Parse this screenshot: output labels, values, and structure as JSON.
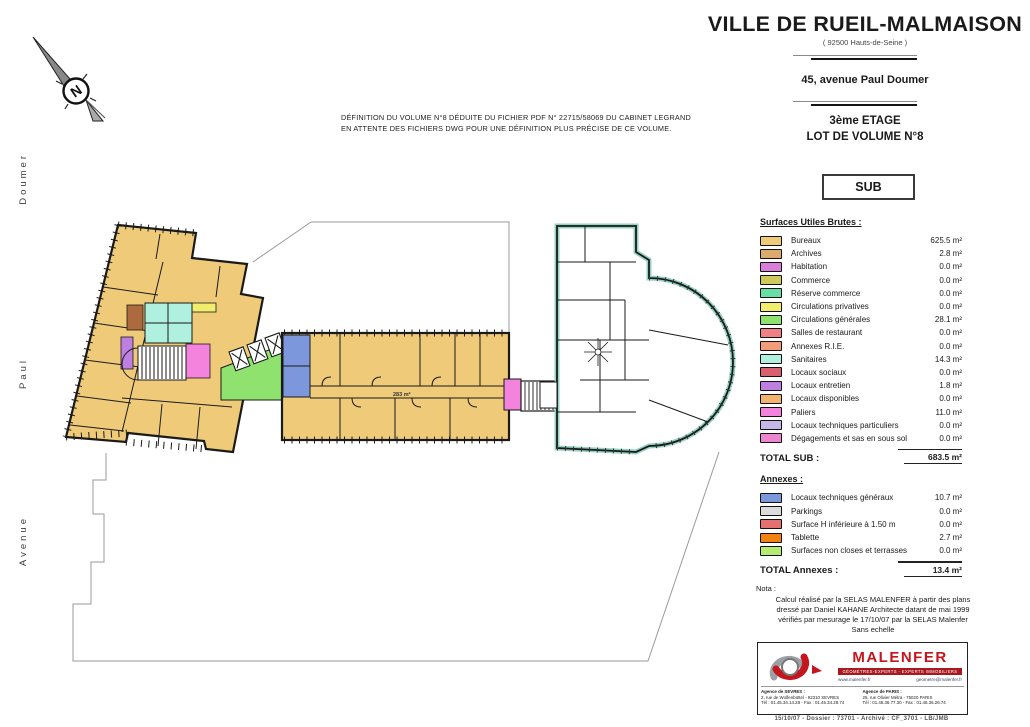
{
  "header": {
    "city": "VILLE DE RUEIL-MALMAISON",
    "dept": "( 92500 Hauts-de-Seine )",
    "address": "45, avenue Paul Doumer",
    "floor": "3ème ETAGE",
    "lot": "LOT DE VOLUME N°8",
    "type_label": "SUB"
  },
  "plan_note": {
    "line1": "DÉFINITION DU VOLUME N°8 DÉDUITE DU FICHIER PDF N° 22715/58069 DU CABINET LEGRAND",
    "line2": "EN ATTENTE DES FICHIERS DWG POUR UNE DÉFINITION PLUS PRÉCISE DE CE VOLUME."
  },
  "streets": {
    "top": "Doumer",
    "middle": "Paul",
    "bottom": "Avenue"
  },
  "compass": {
    "label": "N"
  },
  "plan": {
    "corridor_label": "283 m²",
    "colors": {
      "archives_room": "#ad6a3e",
      "teal_outline": "#93d2c3",
      "boundary": "#9a9a9a",
      "wall": "#1a1a1a"
    }
  },
  "legend": {
    "title": "Surfaces Utiles Brutes :",
    "items": [
      {
        "label": "Bureaux",
        "value": "625.5 m²",
        "color": "#EFCB79"
      },
      {
        "label": "Archives",
        "value": "2.8 m²",
        "color": "#DCA96E"
      },
      {
        "label": "Habitation",
        "value": "0.0 m²",
        "color": "#DA7FD9"
      },
      {
        "label": "Commerce",
        "value": "0.0 m²",
        "color": "#CDC95B"
      },
      {
        "label": "Réserve commerce",
        "value": "0.0 m²",
        "color": "#66DFA6"
      },
      {
        "label": "Circulations privatives",
        "value": "0.0 m²",
        "color": "#F1EE6E"
      },
      {
        "label": "Circulations générales",
        "value": "28.1 m²",
        "color": "#90E26E"
      },
      {
        "label": "Salles de restaurant",
        "value": "0.0 m²",
        "color": "#F08083"
      },
      {
        "label": "Annexes R.I.E.",
        "value": "0.0 m²",
        "color": "#F29C79"
      },
      {
        "label": "Sanitaires",
        "value": "14.3 m²",
        "color": "#AFF0DF"
      },
      {
        "label": "Locaux sociaux",
        "value": "0.0 m²",
        "color": "#D9606F"
      },
      {
        "label": "Locaux entretien",
        "value": "1.8 m²",
        "color": "#BD7FE0"
      },
      {
        "label": "Locaux disponibles",
        "value": "0.0 m²",
        "color": "#F2B36E"
      },
      {
        "label": "Paliers",
        "value": "11.0 m²",
        "color": "#F383DC"
      },
      {
        "label": "Locaux techniques particuliers",
        "value": "0.0 m²",
        "color": "#C5B7E8"
      },
      {
        "label": "Dégagements et sas en sous sol",
        "value": "0.0 m²",
        "color": "#EC86CF"
      }
    ],
    "total_label": "TOTAL SUB :",
    "total_value": "683.5 m²",
    "annexes_title": "Annexes :",
    "annex_items": [
      {
        "label": "Locaux techniques généraux",
        "value": "10.7 m²",
        "color": "#7D97DC"
      },
      {
        "label": "Parkings",
        "value": "0.0 m²",
        "color": "#DCDCDC"
      },
      {
        "label": "Surface H inférieure à 1.50 m",
        "value": "0.0 m²",
        "color": "#E57070"
      },
      {
        "label": "Tablette",
        "value": "2.7 m²",
        "color": "#F28211"
      },
      {
        "label": "Surfaces non closes et terrasses",
        "value": "0.0 m²",
        "color": "#B5EC6F"
      }
    ],
    "annex_total_label": "TOTAL Annexes :",
    "annex_total_value": "13.4 m²"
  },
  "nota": {
    "label": "Nota :",
    "lines": [
      "Calcul réalisé par la SELAS MALENFER à partir des plans",
      "dressé par Daniel KAHANE Architecte datant de mai 1999",
      "vérifiés par mesurage le 17/10/07 par la SELAS Malenfer",
      "Sans echelle"
    ]
  },
  "firm": {
    "name": "MALENFER",
    "brand_color": "#c4161c",
    "tagline": "GÉOMÈTRES-EXPERTS - EXPERTS IMMOBILIERS",
    "web": "www.malenfer.fr",
    "email": "geometre@malenfer.fr",
    "agencies": [
      {
        "title": "Agence de SEVRES :",
        "address": "2, rue de Wolfenbüttel - 92310 SEVRES",
        "phone": "Tél : 01.45.34.14.28 - Fax : 01.45.34.28.74"
      },
      {
        "title": "Agence de PARIS :",
        "address": "25, rue Olivier Métra - 75020 PARIS",
        "phone": "Tél : 01.46.36.77.30 - Fax : 01.46.36.26.74"
      }
    ],
    "footer_line": "15/10/07 - Dossier : 73701 - Archivé : CF_3701 - LB/JMB"
  }
}
